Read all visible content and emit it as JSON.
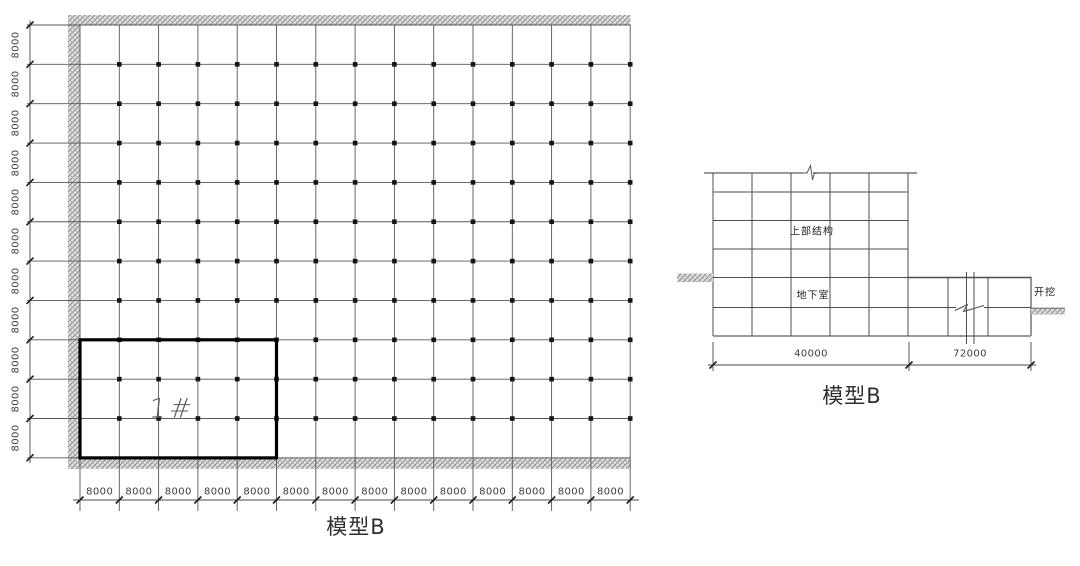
{
  "plan": {
    "caption": "模型B",
    "block_label": "1#",
    "left_dim_labels": [
      "8000",
      "8000",
      "8000",
      "8000",
      "8000",
      "8000",
      "8000",
      "8000",
      "8000",
      "8000",
      "8000"
    ],
    "bottom_dim_labels": [
      "8000",
      "8000",
      "8000",
      "8000",
      "8000",
      "8000",
      "8000",
      "8000",
      "8000",
      "8000",
      "8000",
      "8000",
      "8000",
      "8000"
    ]
  },
  "section": {
    "caption": "模型B",
    "upper_structure_label": "上部结构",
    "basement_label": "地下室",
    "excavation_label": "开挖",
    "dim_left": "40000",
    "dim_right": "72000"
  },
  "colors": {
    "grid_line": "#4f4f4f",
    "bold_outline": "#000000",
    "hatch_gray": "#8f8f8f",
    "text": "#383838"
  }
}
